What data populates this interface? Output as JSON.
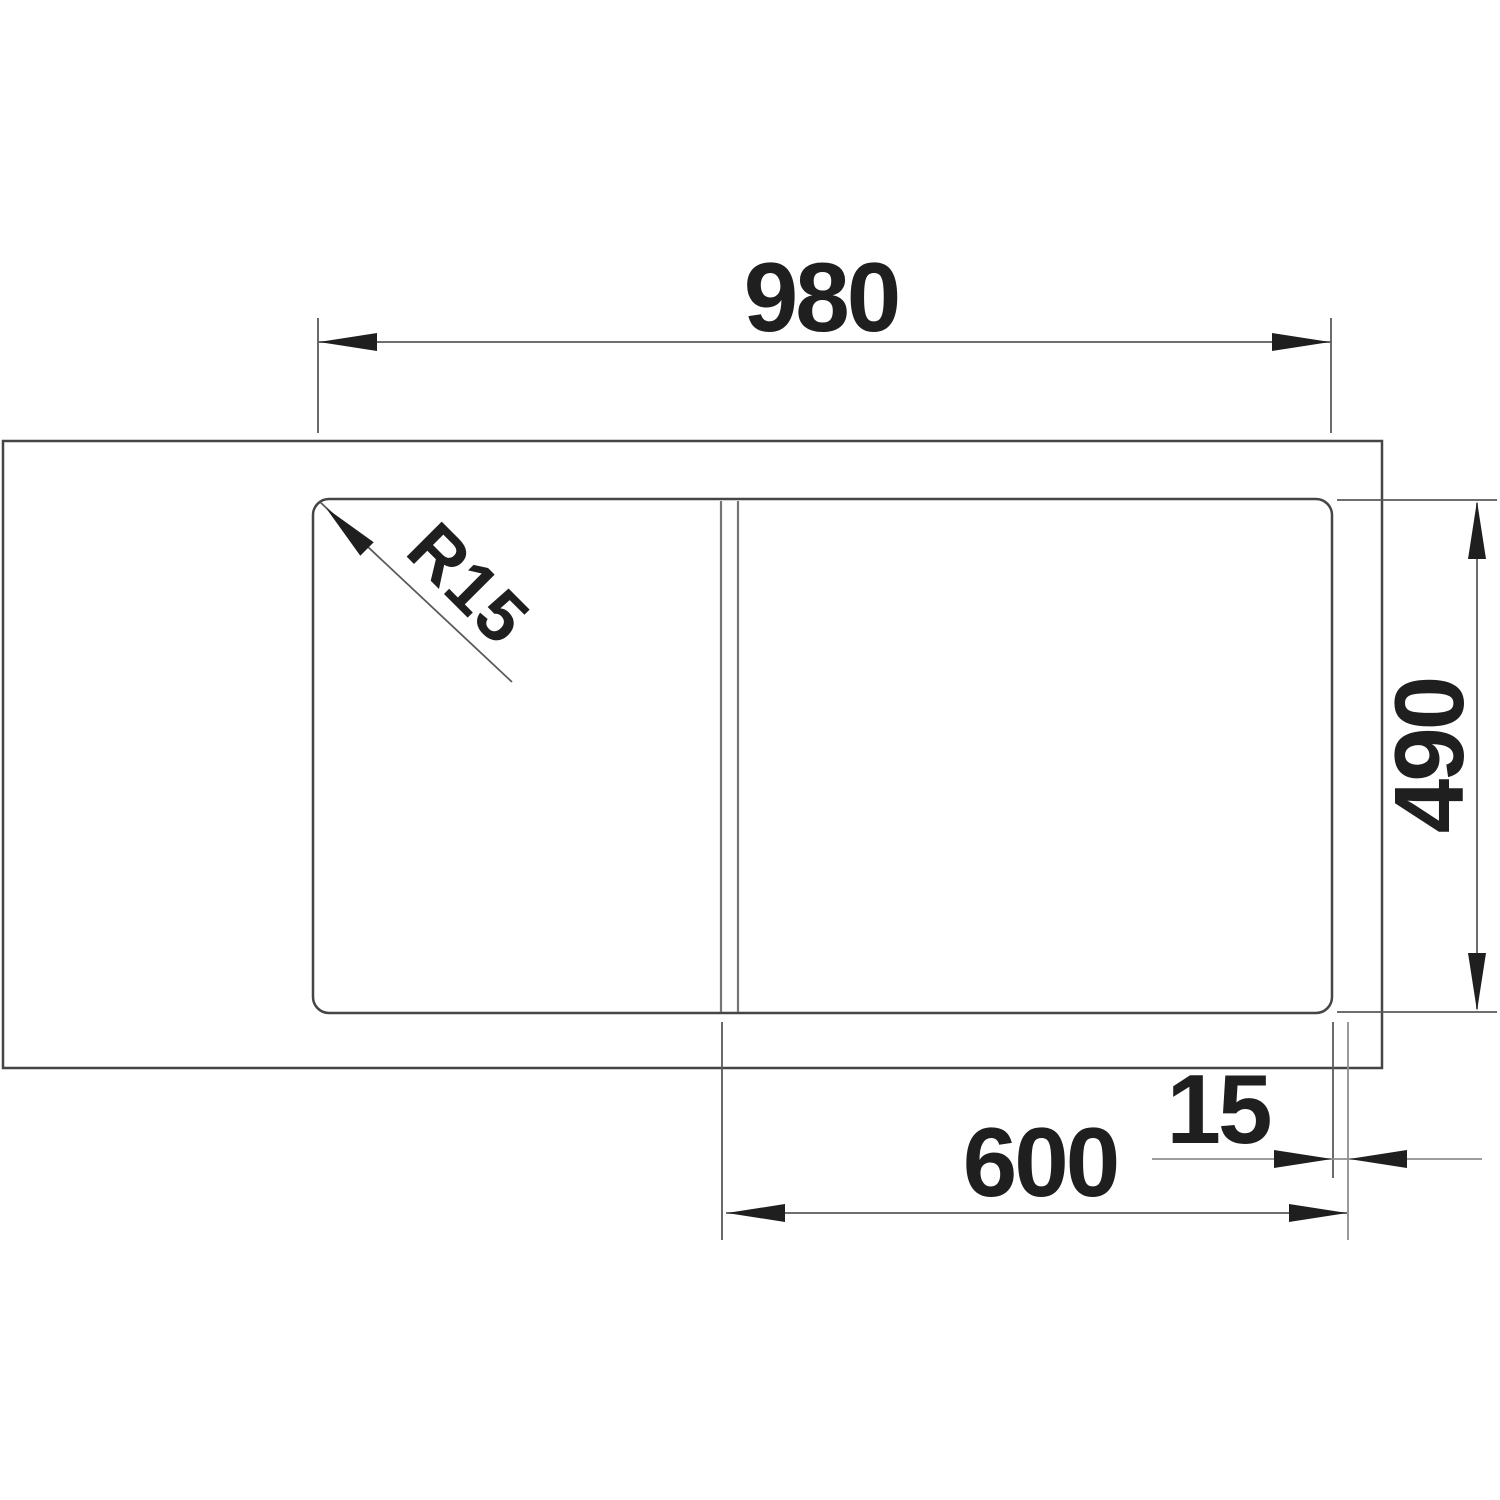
{
  "drawing": {
    "title": "sink-top-view-dimension-drawing",
    "dimensions": {
      "overall_width": "980",
      "overall_depth": "490",
      "cabinet_width": "600",
      "edge_offset": "15",
      "corner_radius": "R15"
    },
    "colors": {
      "background": "#ffffff",
      "outline": "#454545",
      "divider": "#757575",
      "dimension": "#5a5a5a",
      "extension_light": "#8f8f8f",
      "arrow": "#1f1f1f",
      "text": "#1f1f1f"
    }
  }
}
